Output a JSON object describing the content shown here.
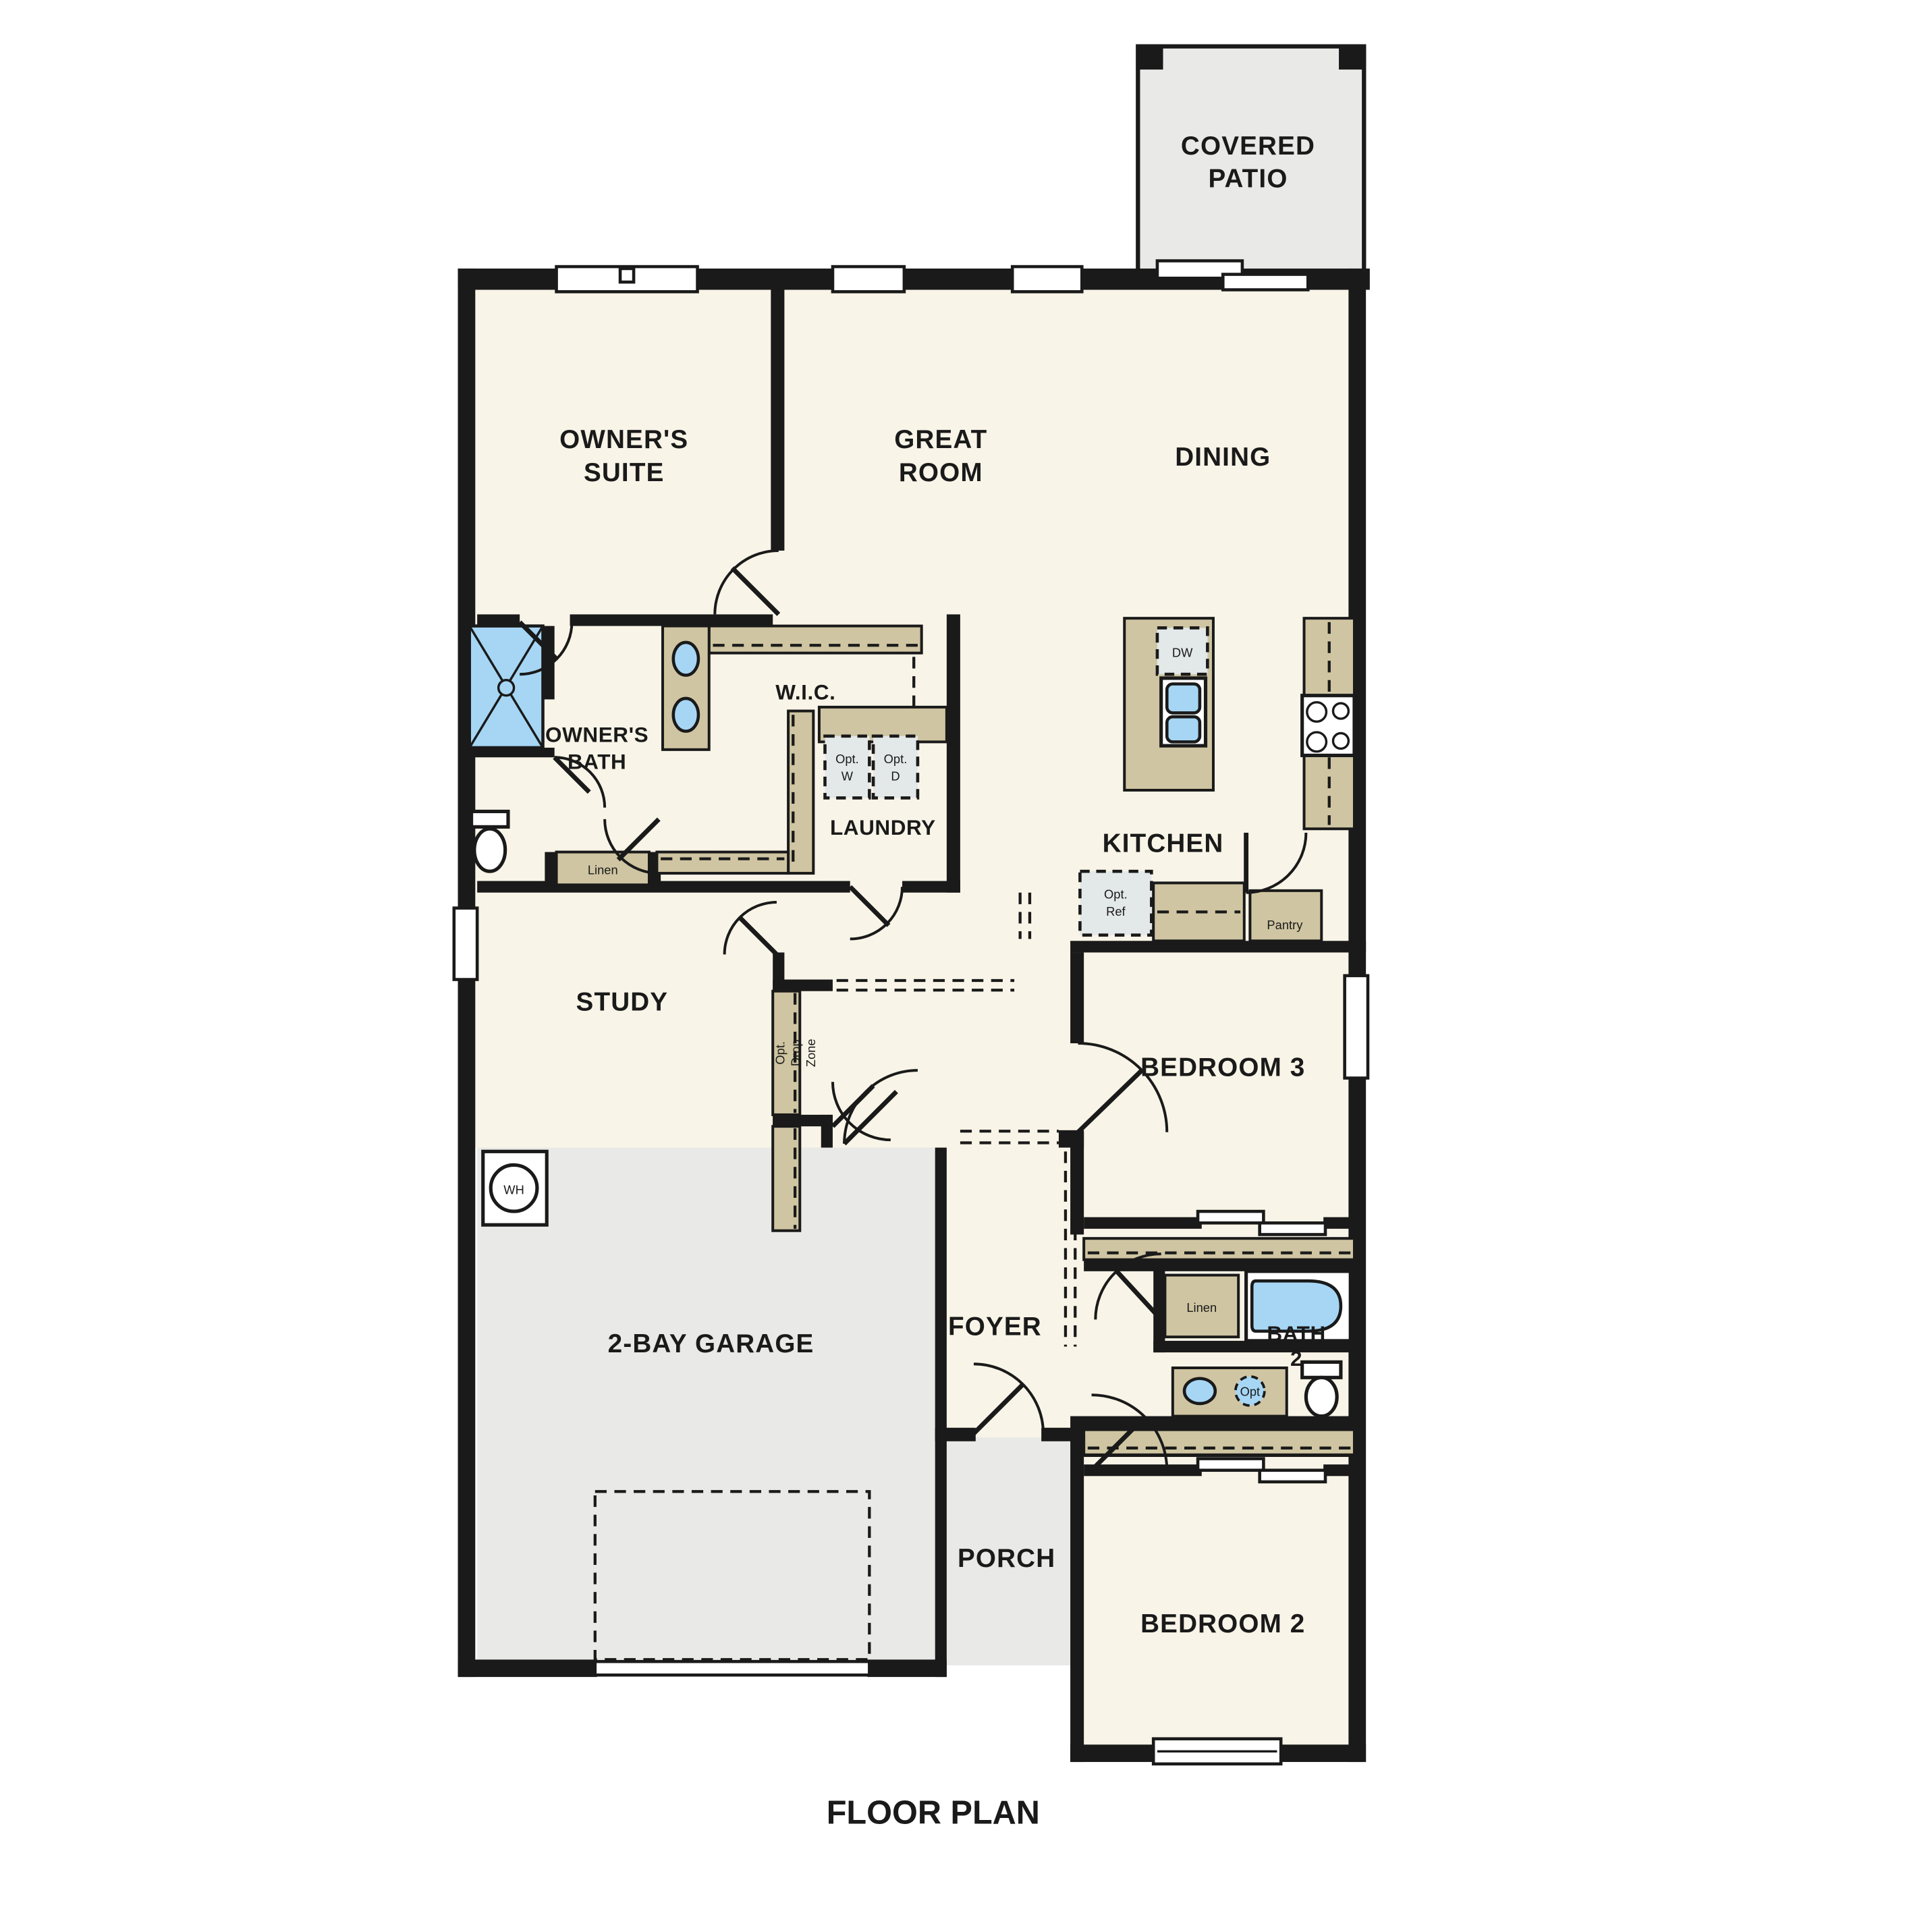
{
  "title": "FLOOR PLAN",
  "colors": {
    "background": "#ffffff",
    "floor_cream": "#f8f4e7",
    "concrete_gray": "#e9e9e7",
    "casework_tan": "#cfc5a2",
    "fixture_blue": "#a6d6f4",
    "wall_black": "#1a1a1a"
  },
  "rooms": {
    "covered_patio": [
      "COVERED",
      "PATIO"
    ],
    "owners_suite": [
      "OWNER'S",
      "SUITE"
    ],
    "great_room": [
      "GREAT",
      "ROOM"
    ],
    "dining": "DINING",
    "owners_bath": [
      "OWNER'S",
      "BATH"
    ],
    "wic": "W.I.C.",
    "laundry": "LAUNDRY",
    "kitchen": "KITCHEN",
    "study": "STUDY",
    "bedroom3": "BEDROOM 3",
    "foyer": "FOYER",
    "bath2": [
      "BATH",
      "2"
    ],
    "garage": "2-BAY GARAGE",
    "porch": "PORCH",
    "bedroom2": "BEDROOM 2"
  },
  "fixtures": {
    "dw": "DW",
    "opt_w": [
      "Opt.",
      "W"
    ],
    "opt_d": [
      "Opt.",
      "D"
    ],
    "opt_ref": [
      "Opt.",
      "Ref"
    ],
    "pantry": "Pantry",
    "linen_owners": "Linen",
    "linen_bath2": "Linen",
    "water_heater": "WH",
    "opt_second_sink": "Opt",
    "drop_zone": [
      "Opt.",
      "Drop",
      "Zone"
    ]
  }
}
